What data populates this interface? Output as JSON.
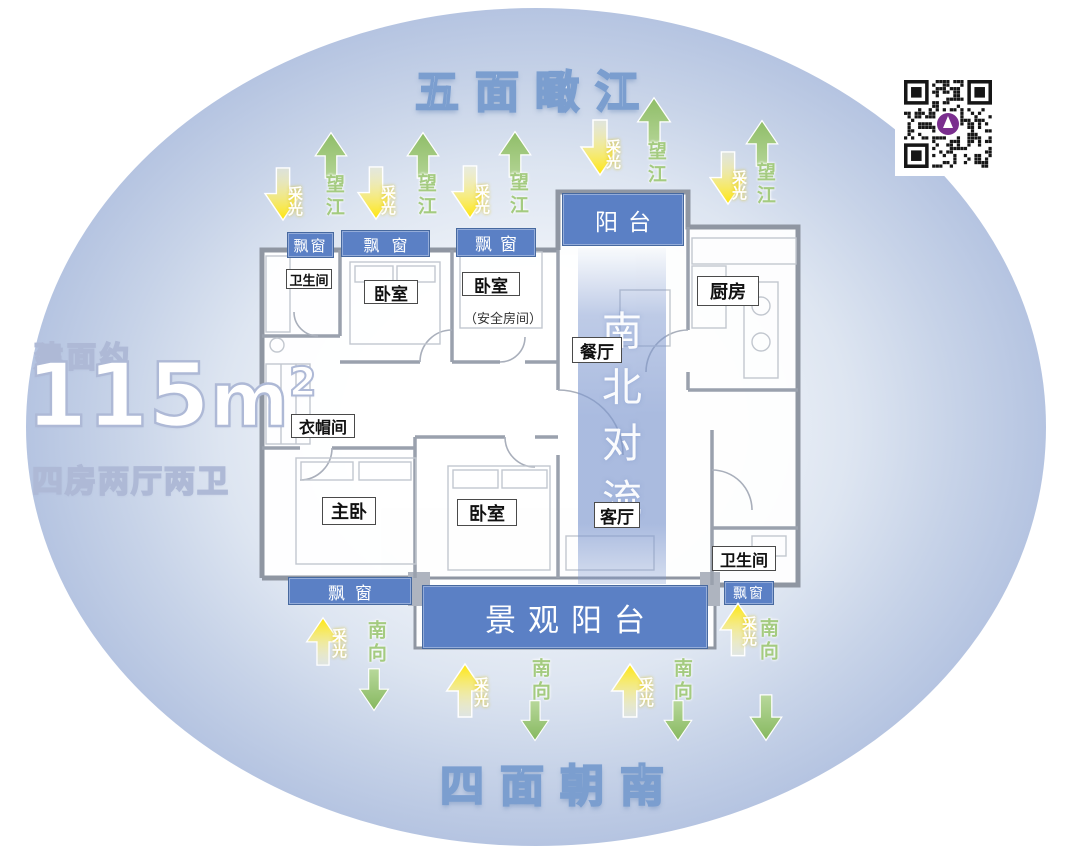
{
  "titles": {
    "top": "五面瞰江",
    "bottom": "四面朝南"
  },
  "area_info": {
    "prefix": "建面约",
    "value": "115",
    "unit": "m",
    "sup": "2",
    "config": "四房两厅两卫"
  },
  "flow": {
    "c0": "南",
    "c1": "北",
    "c2": "对",
    "c3": "流"
  },
  "labels": {
    "bay_window": "飘窗",
    "balcony": "阳台",
    "scenic_balcony": "景观阳台",
    "bathroom": "卫生间",
    "bedroom": "卧室",
    "safe_room": "（安全房间）",
    "kitchen": "厨房",
    "dining_room": "餐厅",
    "cloakroom": "衣帽间",
    "master_bedroom": "主卧",
    "living_room": "客厅"
  },
  "arrows": {
    "daylight": "采光",
    "river_view": "望江",
    "south_facing": "南向"
  },
  "colors": {
    "blue_label": "#5b80c5",
    "flow_band": "#7e98cf",
    "green_arrow": "#9cc579",
    "yellow_arrow": "#ffe60a",
    "title_stroke": "#7b9ecf",
    "qr_logo": "#7a2e8e"
  }
}
